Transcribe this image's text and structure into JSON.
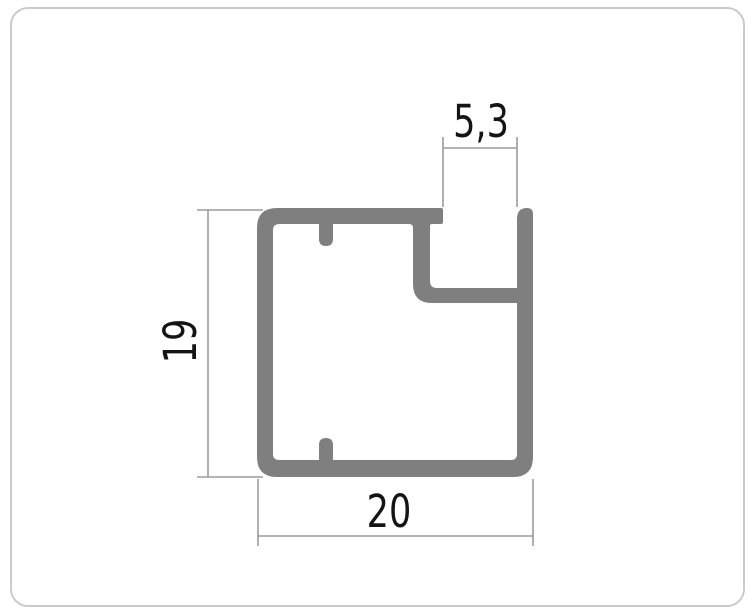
{
  "drawing": {
    "labels": {
      "width": "20",
      "height": "19",
      "slot_width": "5,3"
    }
  },
  "colors": {
    "profile_fill": "#7f7f7f",
    "dim_line": "#9b9b9b",
    "dim_text": "#141414",
    "frame_border": "#c9cacb",
    "background": "#ffffff"
  }
}
